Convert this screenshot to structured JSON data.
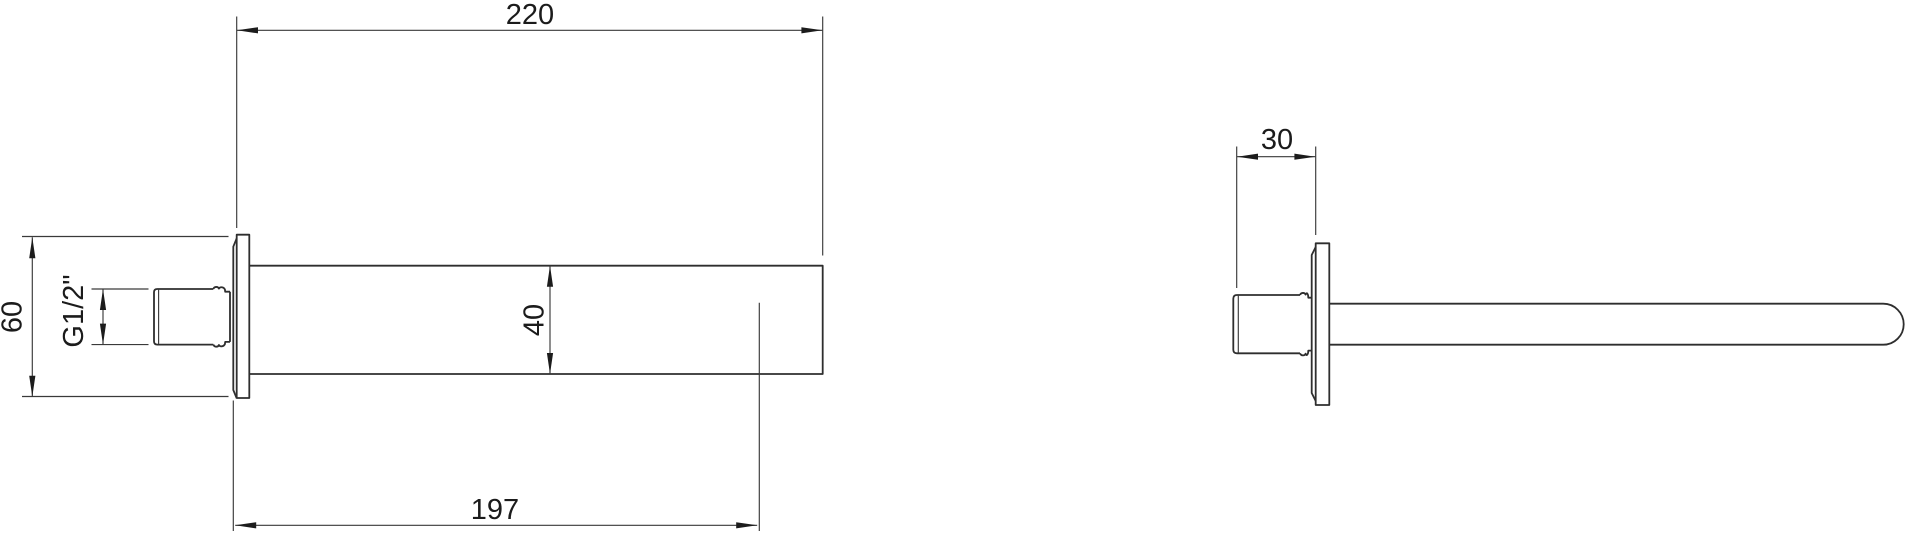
{
  "drawing": {
    "type": "technical-dimension-drawing",
    "subject": "wall-mounted spout, two orthographic views",
    "background_color": "#ffffff",
    "line_color": "#2e2e2e",
    "dimension_color": "#3a3a3a",
    "side_view": {
      "dim_total_length": "220",
      "dim_plate_height": "60",
      "dim_thread_size": "G1/2\"",
      "dim_spout_height": "40",
      "dim_outlet_projection": "197"
    },
    "top_view": {
      "dim_thread_depth": "30"
    }
  }
}
